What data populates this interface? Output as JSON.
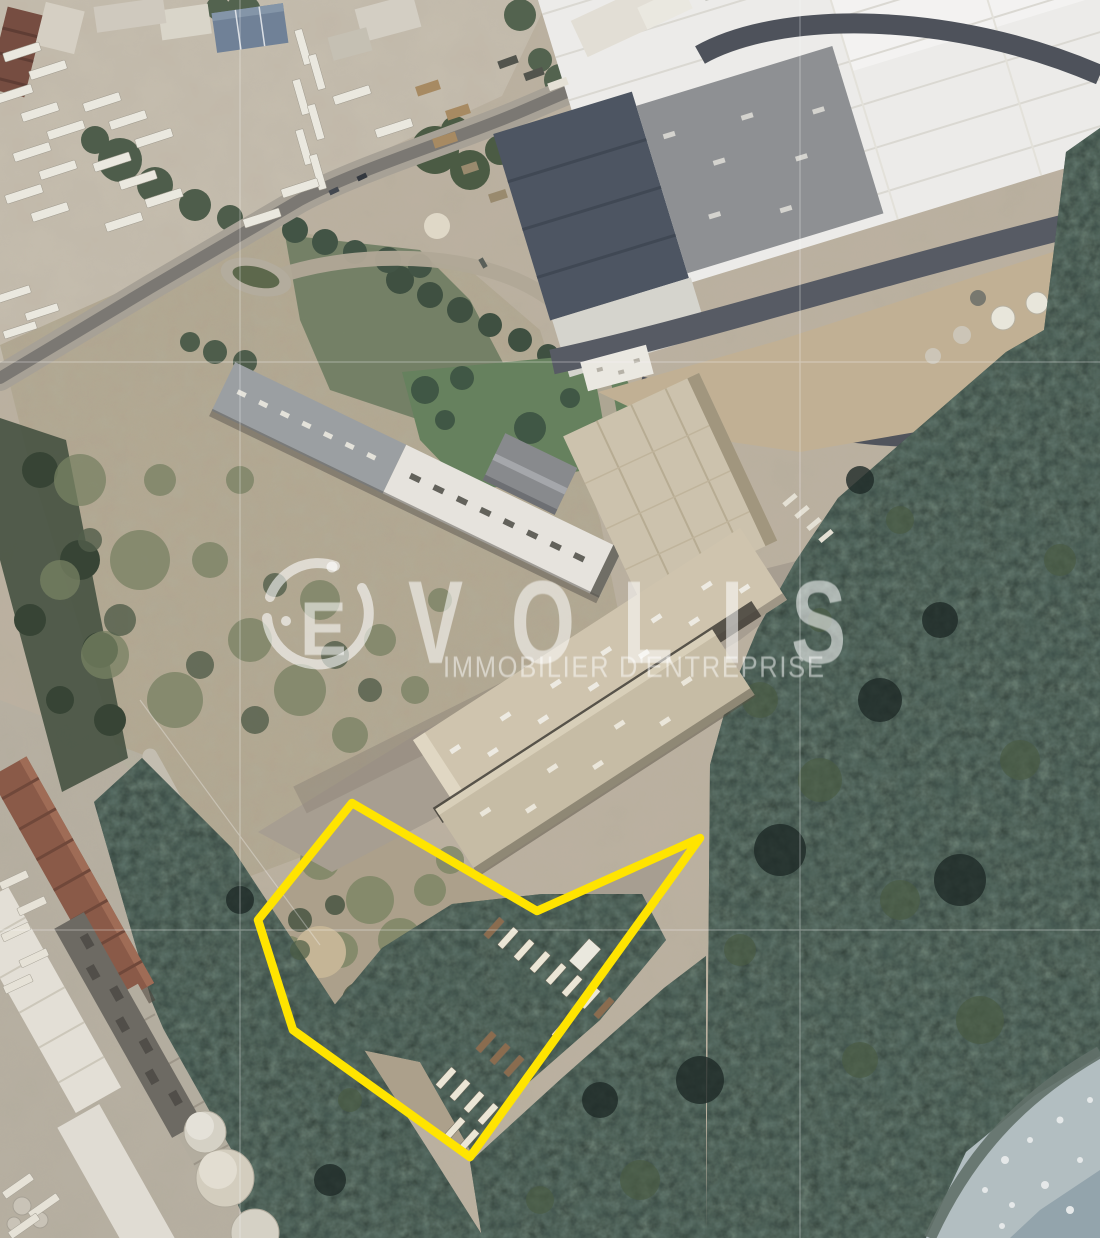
{
  "meta": {
    "image_type": "satellite aerial photograph",
    "subject": "industrial site with highlighted land parcel"
  },
  "watermark": {
    "brand_initial": "E",
    "brand_rest": "VOLIS",
    "tagline": "IMMOBILIER D'ENTREPRISE"
  },
  "annotation": {
    "name": "site-boundary",
    "points": "352,803 537,911 700,838 470,1157 293,1030 258,920",
    "stroke_width": "8.5"
  },
  "colors": {
    "highlight_yellow": "#FFE400",
    "watermark_white": "rgba(255,255,255,0.58)",
    "forest_green": "#27342c",
    "ground_tan": "#beb3a1",
    "warehouse_roof": "#f1f0ec",
    "slate_roof": "#49525e",
    "water_gray": "#b4c0c2"
  }
}
